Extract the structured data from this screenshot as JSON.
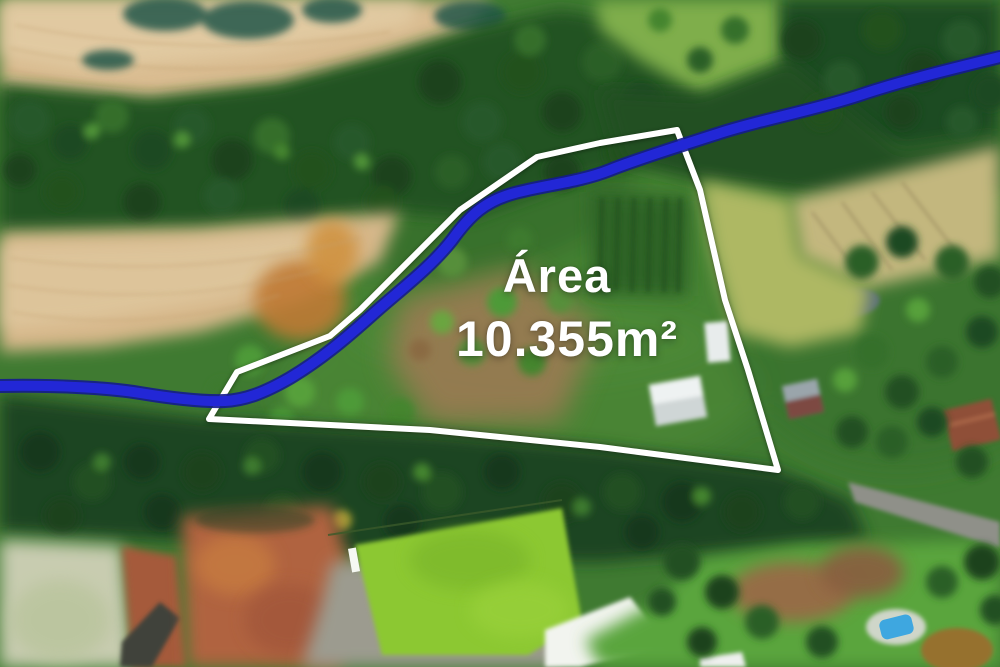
{
  "annotation": {
    "area_label": "Área",
    "area_value": "10.355m²",
    "text_color": "#ffffff",
    "boundary_color": "#ffffff",
    "boundary_points": "677,130 600,143 537,157 460,210 410,260 360,310 330,336 237,372 209,419 430,430 600,447 778,470 748,370 725,300 700,190",
    "river_color": "#2227d6",
    "river_edge_color": "#141b8e",
    "river_path": "M 1000,57 C 955,68 905,80 860,95 C 815,110 760,120 720,133 C 680,146 640,158 610,170 C 580,182 545,185 515,193 C 485,201 470,215 452,240 C 430,268 400,290 372,315 C 344,340 320,360 290,378 C 264,393 245,400 225,401 C 200,402 170,398 140,393 C 110,388 60,385 0,386"
  }
}
